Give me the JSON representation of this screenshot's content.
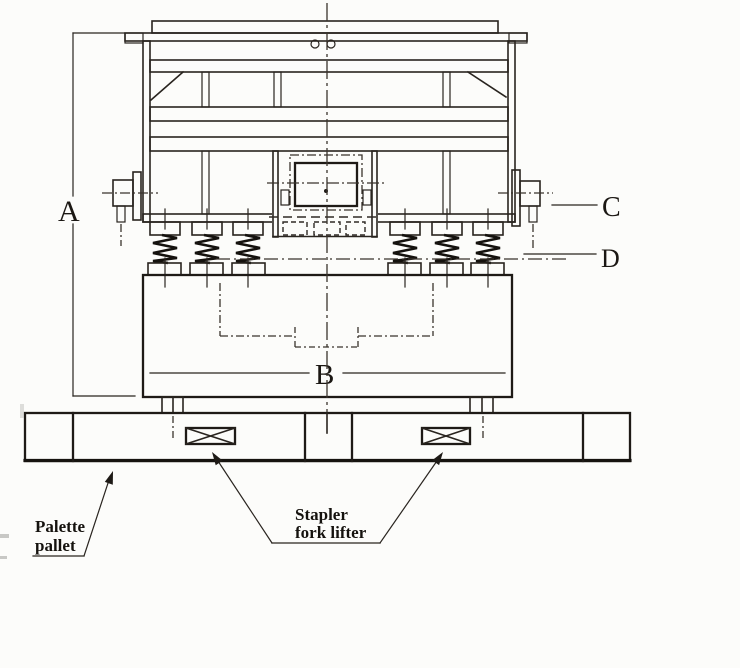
{
  "colors": {
    "background": "#fcfcfa",
    "line": "#29241f",
    "text": "#1b1713"
  },
  "dimensions": {
    "a_label": "A",
    "b_label": "B"
  },
  "callouts": {
    "c_label": "C",
    "d_label": "D"
  },
  "annotations": {
    "pallet": {
      "line1": "Palette",
      "line2": "pallet"
    },
    "forklift": {
      "line1": "Stapler",
      "line2": "fork lifter"
    }
  }
}
